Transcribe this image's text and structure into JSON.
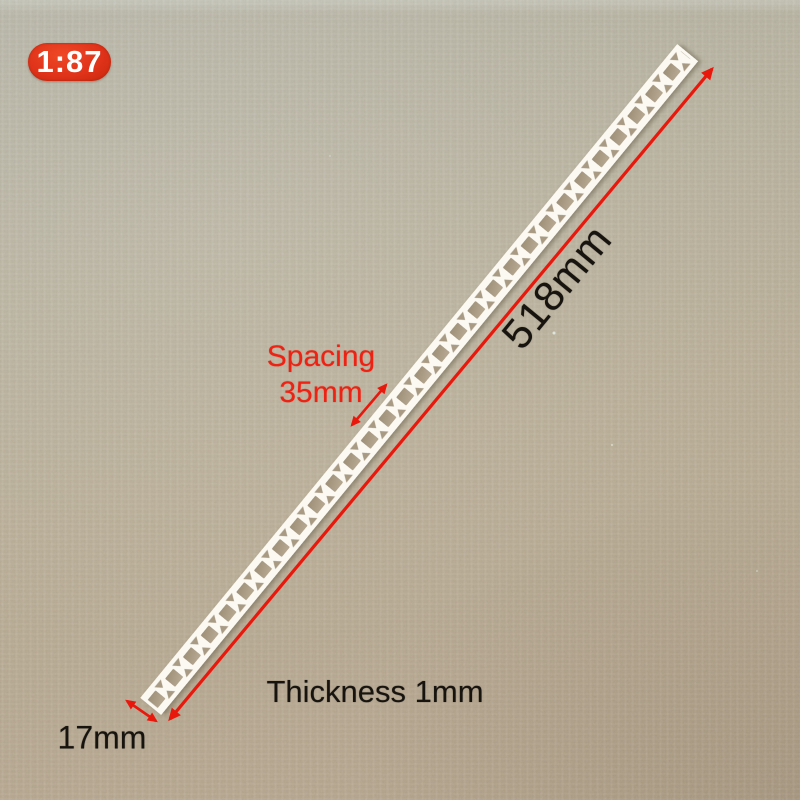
{
  "photo": {
    "badge": {
      "label": "1:87"
    },
    "labels": {
      "length": "518mm",
      "spacing_line1": "Spacing",
      "spacing_line2": "35mm",
      "thickness": "Thickness 1mm",
      "width": "17mm"
    },
    "colors": {
      "annotation_red": "#e9180c",
      "badge_red": "#e0331a",
      "text_black": "#17140f",
      "cardboard_top": "#b3b2a5",
      "cardboard_bottom": "#b0a08a",
      "strip_white": "#fbf9f2",
      "hole_shadow": "#a89a83"
    }
  }
}
